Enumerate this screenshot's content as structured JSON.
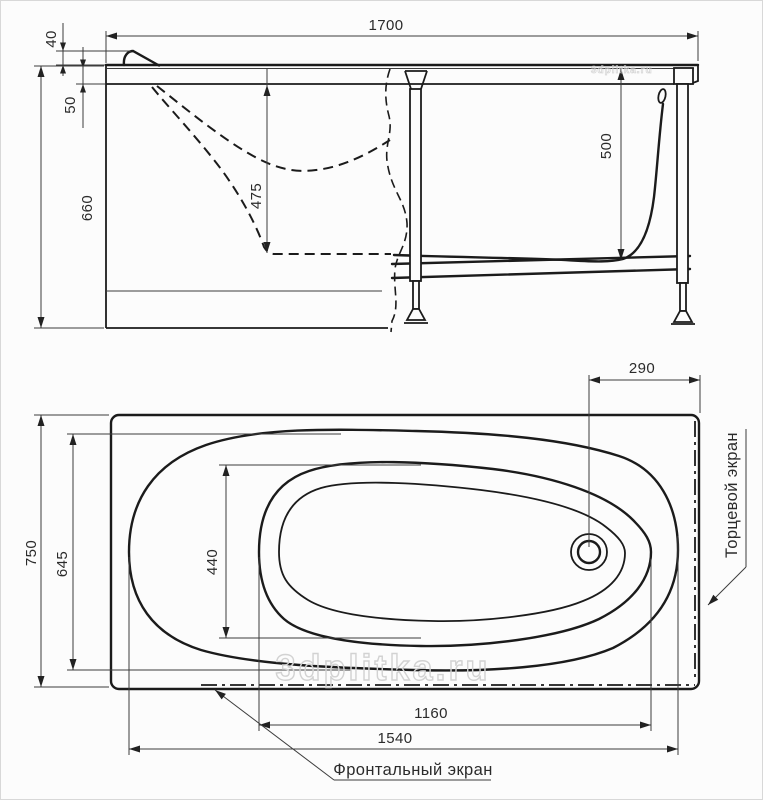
{
  "watermark": {
    "text": "3dplitka.ru"
  },
  "side_view": {
    "dims": {
      "length_total": "1700",
      "headrest_height": "40",
      "rim_height": "50",
      "height_total": "660",
      "depth_front": "475",
      "depth_end": "500"
    }
  },
  "plan_view": {
    "dims": {
      "width_total": "750",
      "width_rim": "645",
      "width_bottom": "440",
      "drain_to_edge": "290",
      "length_bottom": "1160",
      "length_rim": "1540"
    },
    "labels": {
      "end_screen": "Торцевой экран",
      "front_screen": "Фронтальный экран"
    }
  }
}
